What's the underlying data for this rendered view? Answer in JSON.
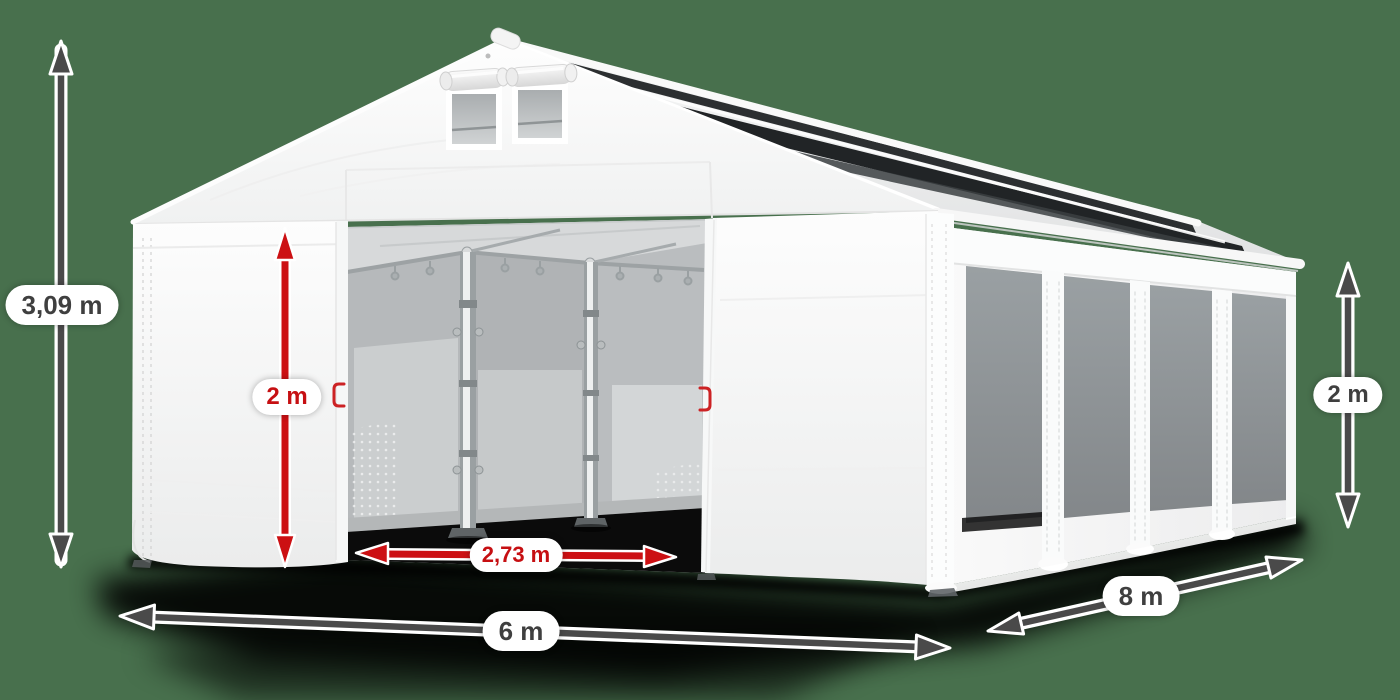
{
  "dimension_labels": {
    "total_height": "3,09 m",
    "entrance_height": "2 m",
    "entrance_width": "2,73 m",
    "front_width": "6 m",
    "side_length": "8 m",
    "wall_height": "2 m"
  },
  "colors": {
    "background": "#48704D",
    "dimension_arrow_dark": "#4A4A4A",
    "dimension_label_text": "#3F3F3F",
    "accent_red": "#CC1013",
    "tent_white": "#FFFFFF",
    "side_window_gray": "#8E9396",
    "roof_panel_dark": "#26292B"
  }
}
